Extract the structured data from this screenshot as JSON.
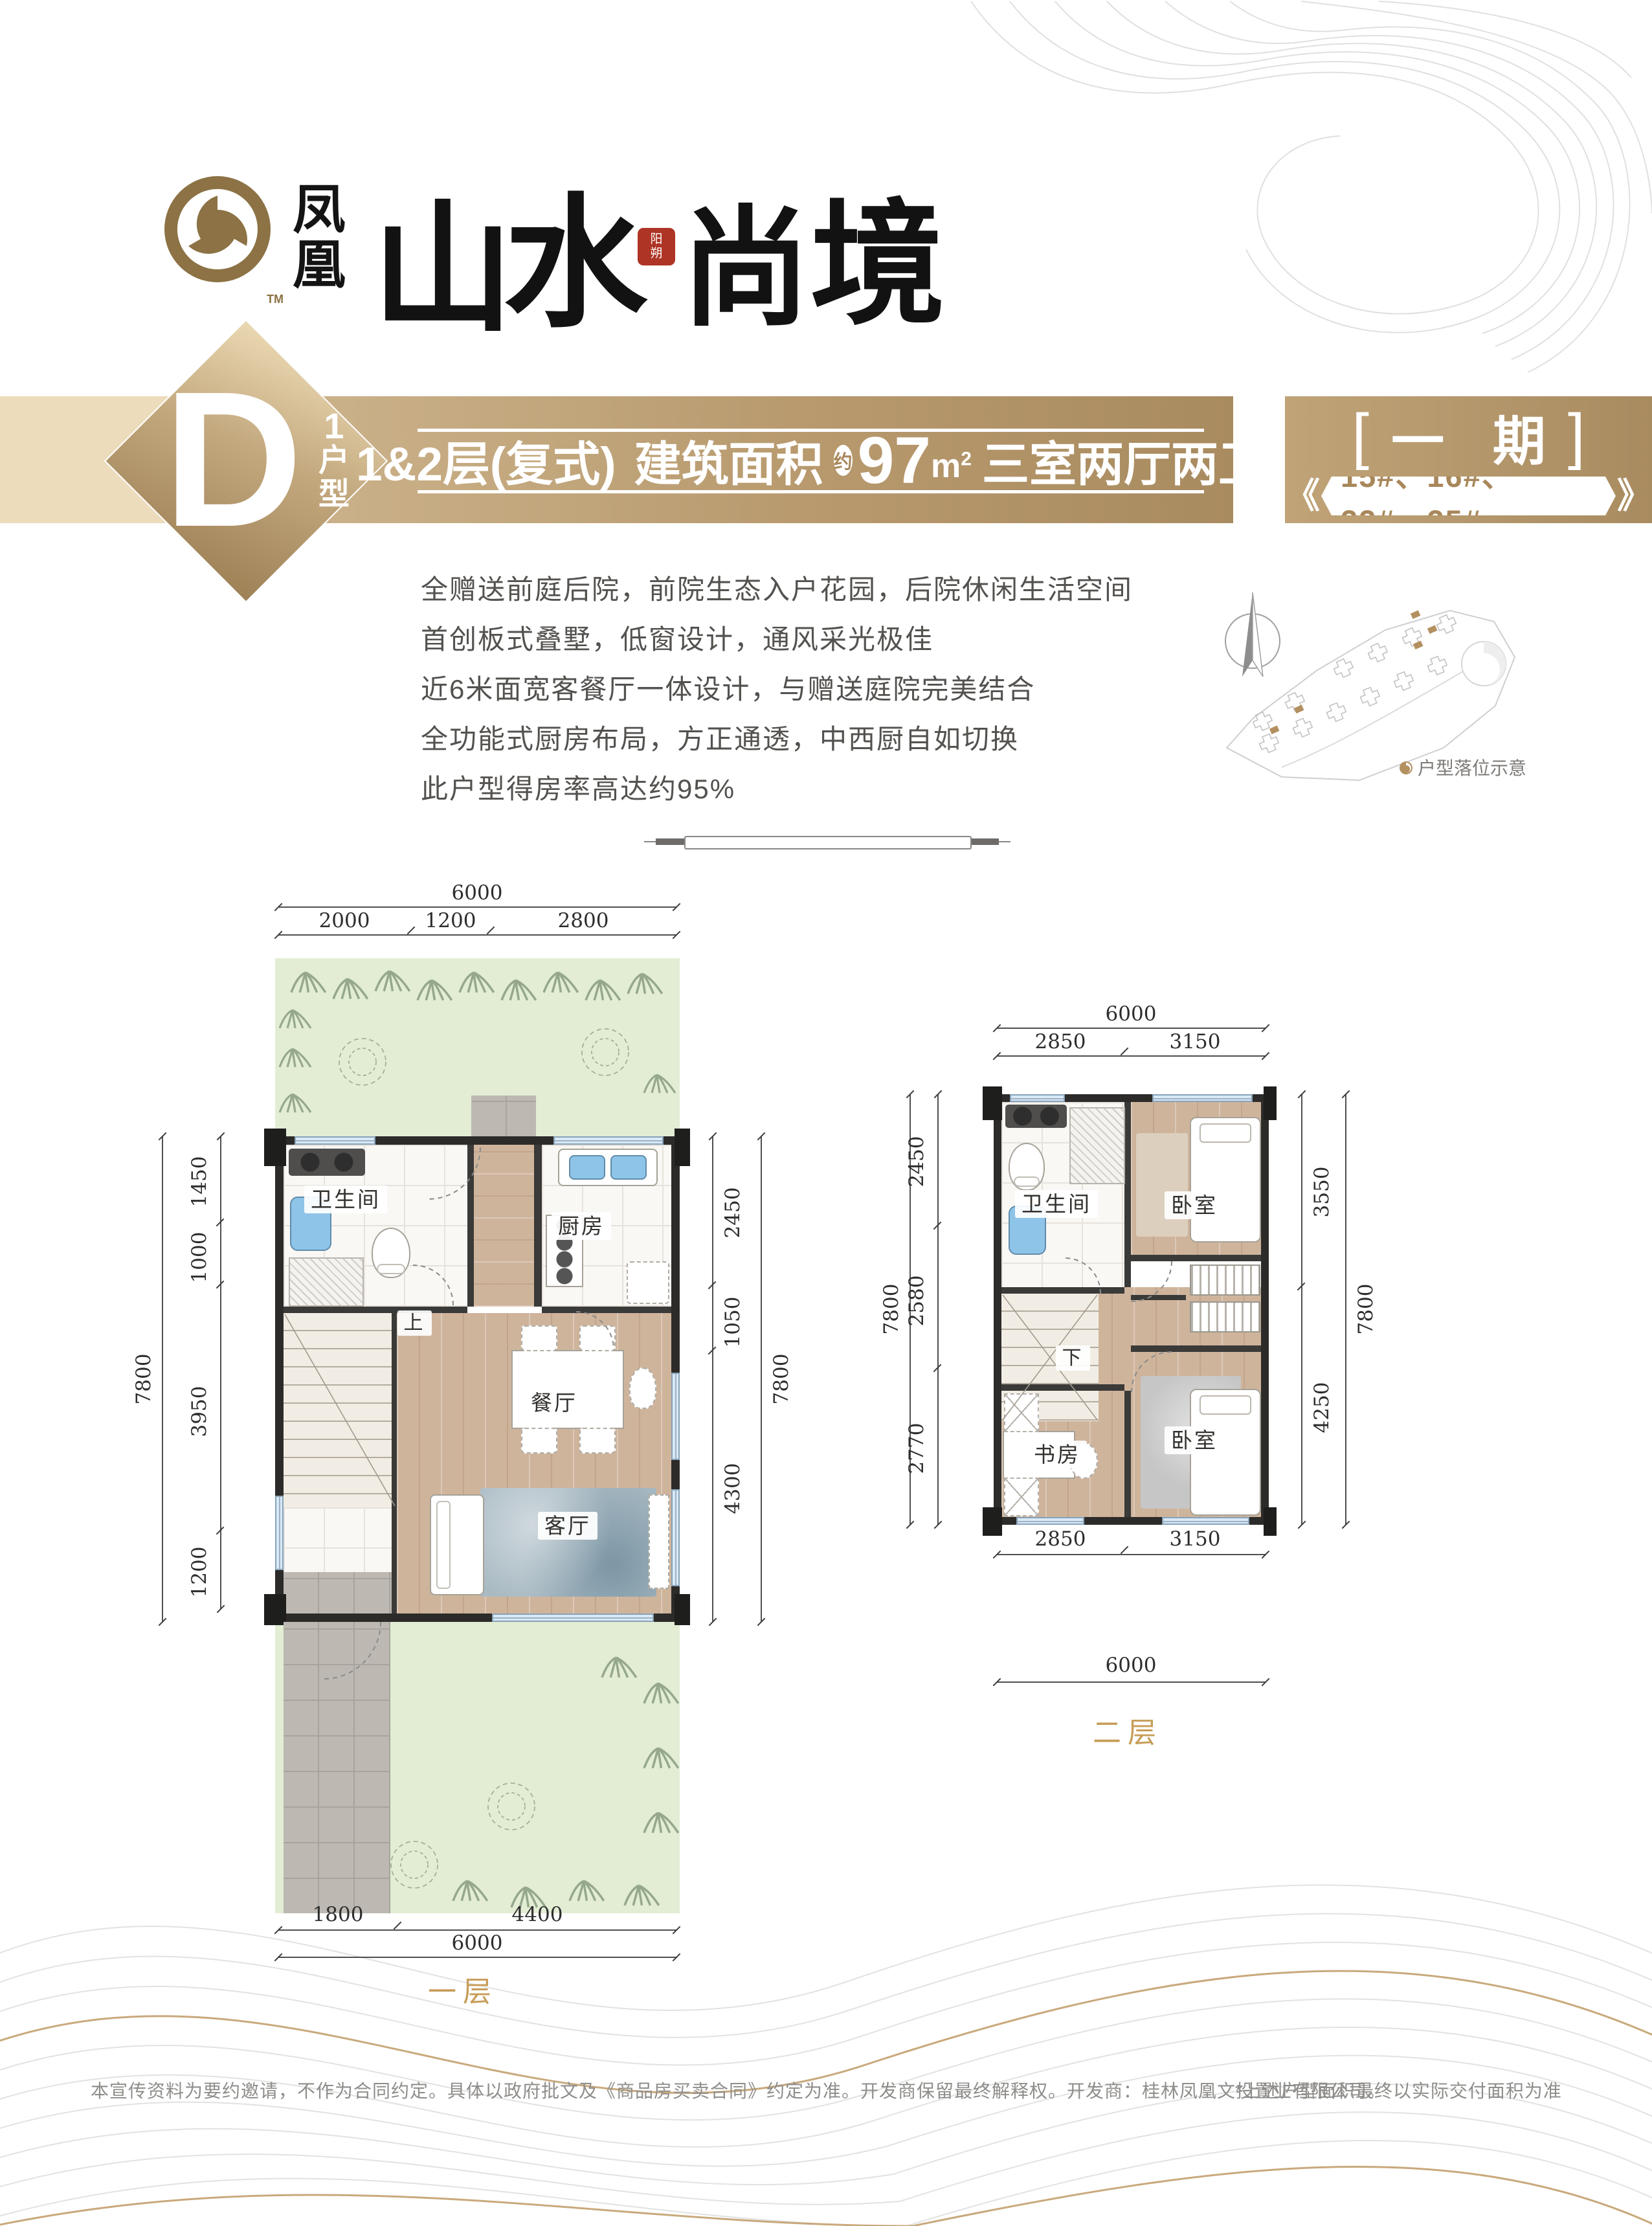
{
  "logo": {
    "brand_vertical": "凤凰",
    "title_chars": [
      "山",
      "水",
      "尚",
      "境"
    ],
    "seal_text": "阳朔",
    "trademark": "TM"
  },
  "header": {
    "unit_letter": "D",
    "unit_number": "1",
    "unit_suffix": "户型",
    "line1_part1": "1&2层(复式)",
    "line1_part2": "建筑面积",
    "approx": "约",
    "area": "97",
    "area_unit_base": "m",
    "area_unit_sup": "2",
    "line1_part3": "三室两厅两卫",
    "phase_open": "[",
    "phase": "一 期",
    "phase_close": "]",
    "chev_left": "《",
    "buildings": "15#、16#、22#、25#",
    "chev_right": "》"
  },
  "features": [
    "全赠送前庭后院，前院生态入户花园，后院休闲生活空间",
    "首创板式叠墅，低窗设计，通风采光极佳",
    "近6米面宽客餐厅一体设计，与赠送庭院完美结合",
    "全功能式厨房布局，方正通透，中西厨自如切换",
    "此户型得房率高达约95%"
  ],
  "siteplan": {
    "label": "户型落位示意"
  },
  "floor1": {
    "label": "一层",
    "rooms": {
      "bath": "卫生间",
      "kitchen": "厨房",
      "dining": "餐厅",
      "living": "客厅",
      "stairs_dir": "上"
    },
    "dims": {
      "top_total": "6000",
      "top_chain": [
        "2000",
        "1200",
        "2800"
      ],
      "left_total": "7800",
      "left_chain": [
        "1450",
        "1000",
        "3950",
        "1200"
      ],
      "right_total": "7800",
      "right_chain": [
        "2450",
        "1050",
        "4300"
      ],
      "bottom_chain": [
        "1800",
        "4400"
      ],
      "bottom_total": "6000"
    }
  },
  "floor2": {
    "label": "二层",
    "rooms": {
      "bath": "卫生间",
      "bedroom_top": "卧室",
      "stairs_dir": "下",
      "study": "书房",
      "bedroom_bottom": "卧室"
    },
    "dims": {
      "top_total": "6000",
      "top_chain": [
        "2850",
        "3150"
      ],
      "left_total": "7800",
      "left_chain": [
        "2450",
        "2580",
        "2770"
      ],
      "right_total": "7800",
      "right_chain": [
        "3550",
        "4250"
      ],
      "bottom_chain": [
        "2850",
        "3150"
      ],
      "bottom_total": "6000"
    }
  },
  "footer": {
    "disclaimer": "本宣传资料为要约邀请，不作为合同约定。具体以政府批文及《商品房买卖合同》约定为准。开发商保留最终解释权。开发商：桂林凤凰文投置业有限公司。",
    "note": "*上述户型面积最终以实际交付面积为准"
  },
  "colors": {
    "gold": "#b8996b",
    "gold_light": "#ecdcbb",
    "gold_dark": "#a5875c",
    "caption_gold": "#c79d58",
    "seal_red": "#ae3425",
    "garden_green": "#e2edd4",
    "window_blue": "#d9e9f7",
    "wall_dark": "#2c2b29"
  }
}
